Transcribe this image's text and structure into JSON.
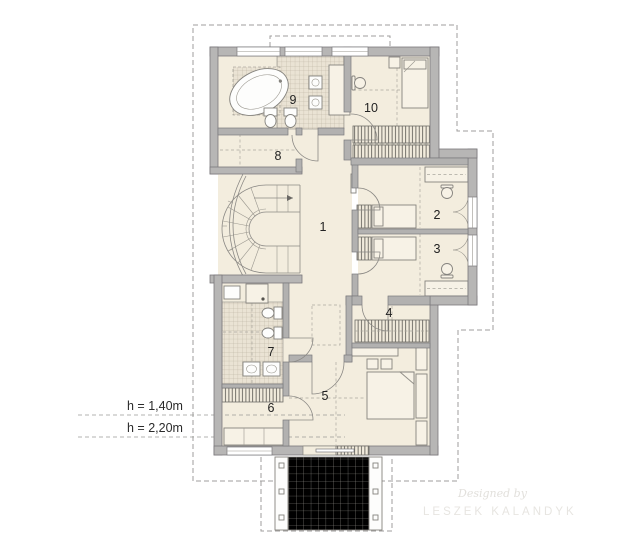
{
  "plan": {
    "room_labels": {
      "r1": "1",
      "r2": "2",
      "r3": "3",
      "r4": "4",
      "r5": "5",
      "r6": "6",
      "r7": "7",
      "r8": "8",
      "r9": "9",
      "r10": "10"
    },
    "height_lines": {
      "line1": "h = 1,40m",
      "line2": "h = 2,20m"
    },
    "watermark": {
      "credit": "Designed by",
      "author": "LESZEK KALANDYK"
    },
    "colors": {
      "wall": "#b7b6b5",
      "floor": "#f3edde",
      "tile": "#eae3d5",
      "line": "#8b8985",
      "dashed": "#9b9a96"
    }
  }
}
